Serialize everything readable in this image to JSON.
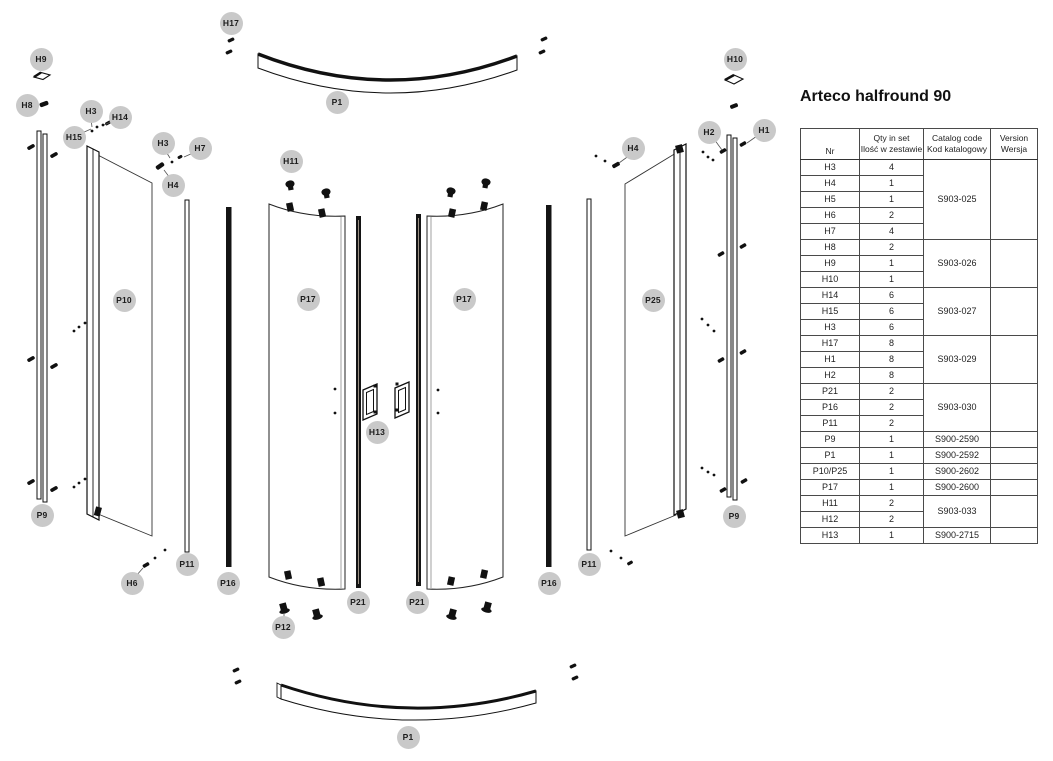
{
  "title": "Arteco halfround 90",
  "table": {
    "headers": {
      "nr": "Nr",
      "qty_en": "Qty in set",
      "qty_pl": "Ilość w zestawie",
      "code_en": "Catalog code",
      "code_pl": "Kod katalogowy",
      "version_en": "Version",
      "version_pl": "Wersja"
    },
    "version_value": "",
    "groups": [
      {
        "code": "S903-025",
        "rows": [
          [
            "H3",
            "4"
          ],
          [
            "H4",
            "1"
          ],
          [
            "H5",
            "1"
          ],
          [
            "H6",
            "2"
          ],
          [
            "H7",
            "4"
          ]
        ]
      },
      {
        "code": "S903-026",
        "rows": [
          [
            "H8",
            "2"
          ],
          [
            "H9",
            "1"
          ],
          [
            "H10",
            "1"
          ]
        ]
      },
      {
        "code": "S903-027",
        "rows": [
          [
            "H14",
            "6"
          ],
          [
            "H15",
            "6"
          ],
          [
            "H3",
            "6"
          ]
        ]
      },
      {
        "code": "S903-029",
        "rows": [
          [
            "H17",
            "8"
          ],
          [
            "H1",
            "8"
          ],
          [
            "H2",
            "8"
          ]
        ]
      },
      {
        "code": "S903-030",
        "rows": [
          [
            "P21",
            "2"
          ],
          [
            "P16",
            "2"
          ],
          [
            "P11",
            "2"
          ]
        ]
      },
      {
        "code": "S900-2590",
        "rows": [
          [
            "P9",
            "1"
          ]
        ]
      },
      {
        "code": "S900-2592",
        "rows": [
          [
            "P1",
            "1"
          ]
        ]
      },
      {
        "code": "S900-2602",
        "rows": [
          [
            "P10/P25",
            "1"
          ]
        ]
      },
      {
        "code": "S900-2600",
        "rows": [
          [
            "P17",
            "1"
          ]
        ]
      },
      {
        "code": "S903-033",
        "rows": [
          [
            "H11",
            "2"
          ],
          [
            "H12",
            "2"
          ]
        ]
      },
      {
        "code": "S900-2715",
        "rows": [
          [
            "H13",
            "1"
          ]
        ]
      }
    ]
  },
  "diagram": {
    "badge_color": "#c9c9c9",
    "line_color": "#1a1a1a",
    "badges": [
      {
        "label": "H17",
        "x": 231,
        "y": 23
      },
      {
        "label": "H9",
        "x": 41,
        "y": 59
      },
      {
        "label": "H8",
        "x": 27,
        "y": 105
      },
      {
        "label": "H3",
        "x": 91,
        "y": 111
      },
      {
        "label": "H14",
        "x": 120,
        "y": 117
      },
      {
        "label": "H15",
        "x": 74,
        "y": 137
      },
      {
        "label": "H3",
        "x": 163,
        "y": 143
      },
      {
        "label": "H7",
        "x": 200,
        "y": 148
      },
      {
        "label": "H4",
        "x": 173,
        "y": 185
      },
      {
        "label": "P1",
        "x": 337,
        "y": 102
      },
      {
        "label": "H11",
        "x": 291,
        "y": 161
      },
      {
        "label": "H10",
        "x": 735,
        "y": 59
      },
      {
        "label": "H2",
        "x": 709,
        "y": 132
      },
      {
        "label": "H1",
        "x": 764,
        "y": 130
      },
      {
        "label": "H4",
        "x": 633,
        "y": 148
      },
      {
        "label": "P10",
        "x": 124,
        "y": 300
      },
      {
        "label": "P17",
        "x": 308,
        "y": 299
      },
      {
        "label": "P17",
        "x": 464,
        "y": 299
      },
      {
        "label": "P25",
        "x": 653,
        "y": 300
      },
      {
        "label": "H13",
        "x": 377,
        "y": 432
      },
      {
        "label": "P9",
        "x": 42,
        "y": 515
      },
      {
        "label": "P9",
        "x": 734,
        "y": 516
      },
      {
        "label": "H6",
        "x": 132,
        "y": 583
      },
      {
        "label": "P11",
        "x": 187,
        "y": 564
      },
      {
        "label": "P16",
        "x": 228,
        "y": 583
      },
      {
        "label": "P16",
        "x": 549,
        "y": 583
      },
      {
        "label": "P11",
        "x": 589,
        "y": 564
      },
      {
        "label": "P21",
        "x": 358,
        "y": 602
      },
      {
        "label": "P21",
        "x": 417,
        "y": 602
      },
      {
        "label": "P12",
        "x": 283,
        "y": 627
      },
      {
        "label": "P1",
        "x": 408,
        "y": 737
      }
    ]
  }
}
